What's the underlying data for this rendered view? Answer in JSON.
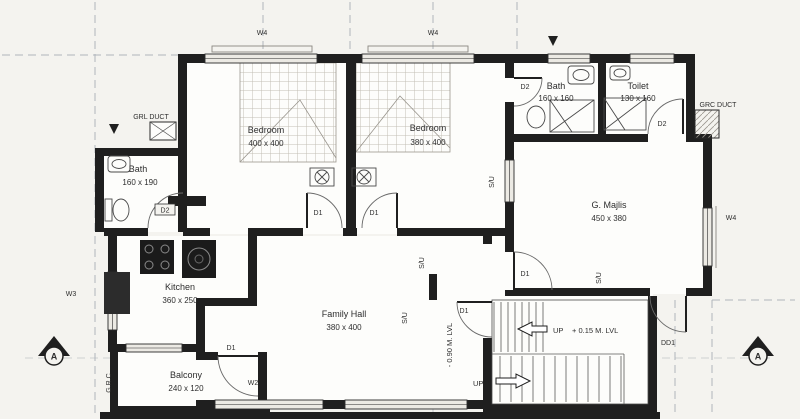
{
  "plan_labels": {
    "rooms": {
      "bedroom1": {
        "name": "Bedroom",
        "size": "400 x 400"
      },
      "bedroom2": {
        "name": "Bedroom",
        "size": "380 x 400"
      },
      "bath_top": {
        "name": "Bath",
        "size": "160 x 160"
      },
      "toilet": {
        "name": "Toilet",
        "size": "130 x 160"
      },
      "majlis": {
        "name": "G. Majlis",
        "size": "450 x 380"
      },
      "bath_left": {
        "name": "Bath",
        "size": "160 x 190"
      },
      "kitchen": {
        "name": "Kitchen",
        "size": "360 x 250"
      },
      "family_hall": {
        "name": "Family Hall",
        "size": "380 x 400"
      },
      "balcony": {
        "name": "Balcony",
        "size": "240 x 120"
      }
    },
    "stairs": {
      "up": "UP",
      "upper_level": "+ 0.15 M. LVL",
      "lower_level": "- 0.90 M. LVL"
    },
    "doors": {
      "d1": "D1",
      "d2": "D2",
      "dd1": "DD1"
    },
    "windows": {
      "w2": "W2",
      "w3": "W3",
      "w4": "W4"
    },
    "ducts": {
      "grl": "GRL DUCT",
      "grc": "GRC DUCT",
      "grc_side": "G.R.C"
    },
    "vents": {
      "su": "S/U"
    },
    "section_marker": "A"
  },
  "colors": {
    "paper": "#f4f3ef",
    "ink": "#1f1f1f",
    "window_fill": "#eceae4",
    "grid_dash": "#98a0aa"
  }
}
